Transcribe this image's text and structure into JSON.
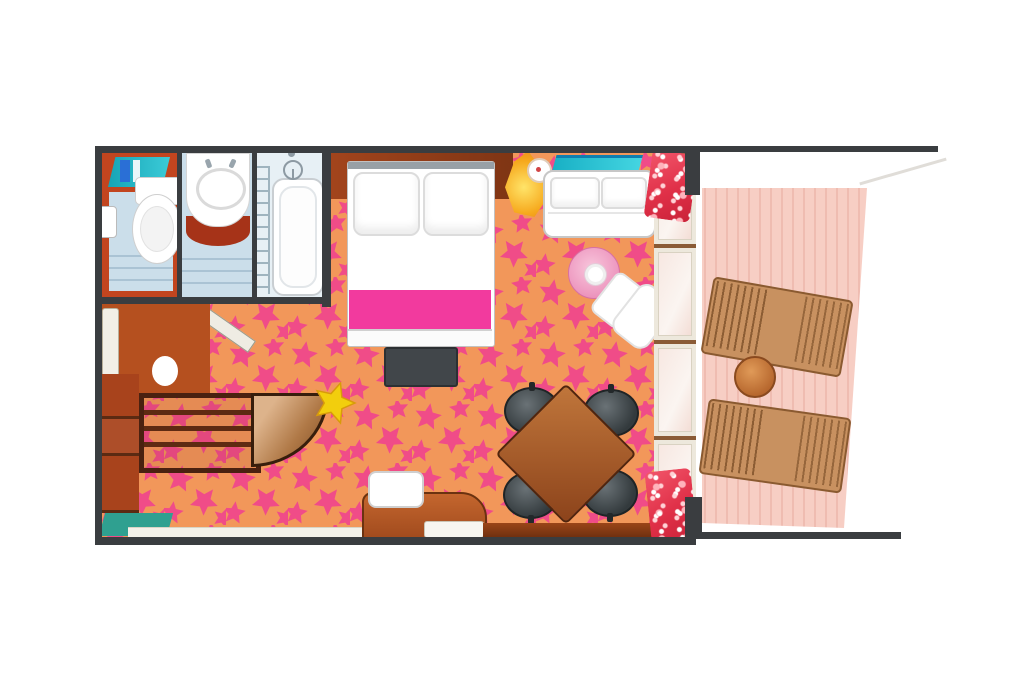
{
  "scene": {
    "type": "floorplan",
    "subject": "cruise-ship-suite-cabin-with-balcony",
    "style": "top-down illustrated plan, no text labels",
    "counts": {
      "dining_chairs": 4,
      "lounge_chairs": 2,
      "glass_door_panels": 4,
      "bath_compartments": 3
    }
  },
  "palette": {
    "wall": "#3A3D40",
    "carpet_base": "#F2975A",
    "carpet_star": "#F1478A",
    "bed_accent": "#F23A9E",
    "bath_red": "#C2451F",
    "bath_floor": "#CBDEEA",
    "teal_shelf": "#25C2D2",
    "mat_teal": "#2FA090",
    "deck": "#F7CEC4",
    "deck_stripe": "#EFBCB1",
    "lounge_wood": "#C89160",
    "wood_light": "#C4662E",
    "wood_dark": "#6B3210",
    "chair_dark": "#3A4043",
    "lamp_yellow": "#F7C51E",
    "floral_red": "#E03048"
  },
  "rooms": {
    "bathroom": {
      "label": "bathroom",
      "furniture": [
        "toiletry-shelf",
        "toilet",
        "toilet-paper-holder",
        "sink-vanity",
        "bathtub",
        "shower-head",
        "towel-ladder",
        "bathroom-door"
      ]
    },
    "entry": {
      "label": "entry",
      "furniture": [
        "entry-door",
        "side-cabinets",
        "wardrobe-shelves",
        "wardrobe-curved-door",
        "teal-mat",
        "yellow-starfish-decor"
      ]
    },
    "bedroom": {
      "label": "bedroom",
      "furniture": [
        "headboard-counter",
        "double-bed",
        "pillows",
        "pink-runner",
        "foot-bench",
        "wall-lamp",
        "wall-sconces",
        "glass-shelf",
        "loveseat"
      ]
    },
    "living": {
      "label": "living-area",
      "furniture": [
        "pink-side-table",
        "white-armchair",
        "dining-table",
        "dining-chairs",
        "desk",
        "stool",
        "serving-tray",
        "sideboard",
        "floral-curtains"
      ]
    },
    "balcony": {
      "label": "balcony",
      "furniture": [
        "lounge-chair-upper",
        "lounge-chair-lower",
        "round-drinks-table"
      ],
      "floor": "pink-wood-plank-deck",
      "access": "glass-door-wall"
    }
  }
}
